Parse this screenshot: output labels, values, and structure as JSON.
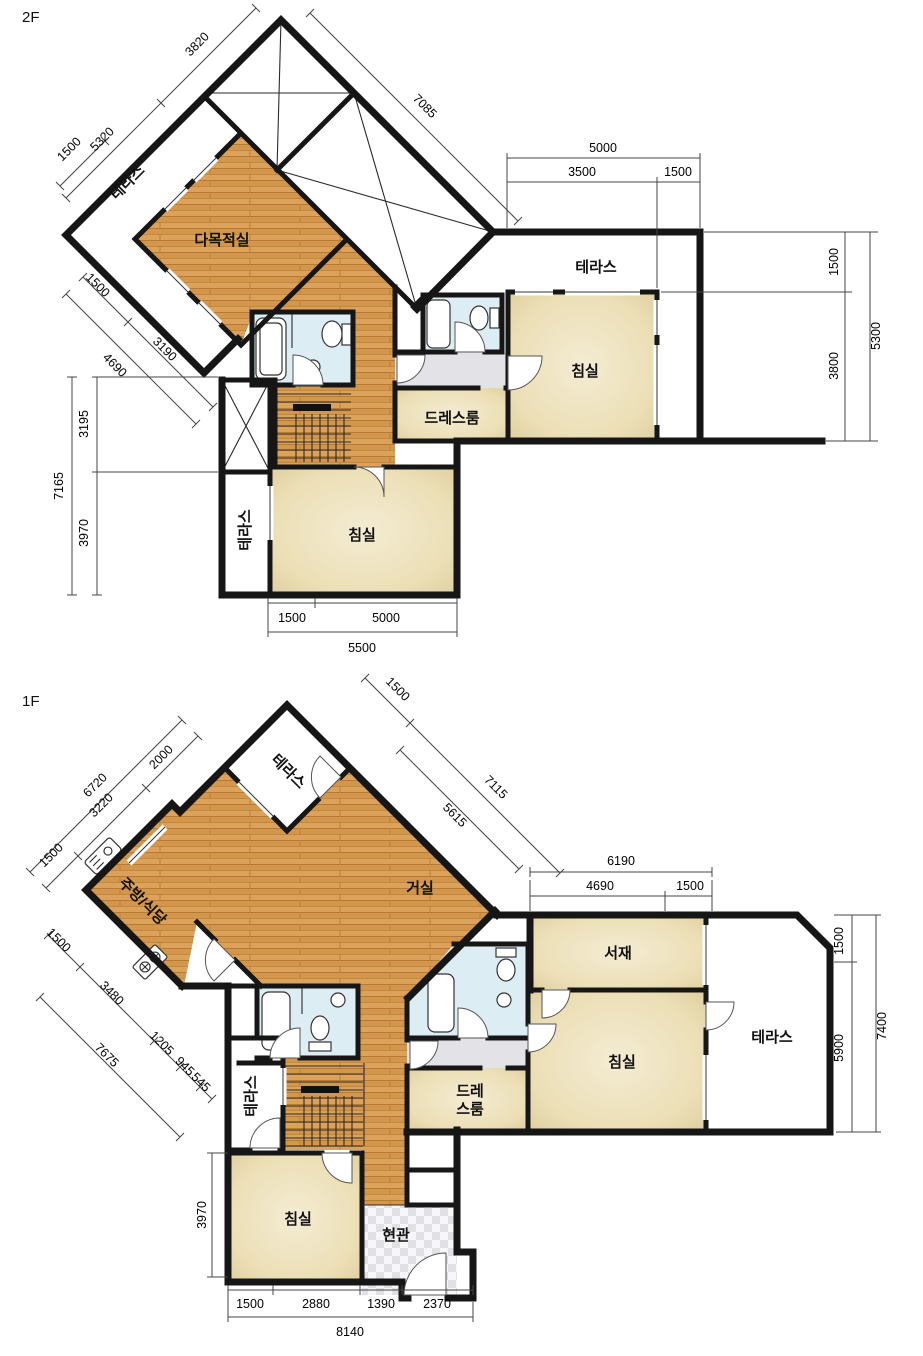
{
  "floors": [
    {
      "label": "2F",
      "rooms": {
        "terrace_nw": "테라스",
        "multi": "다목적실",
        "terrace_e": "테라스",
        "bedroom_e": "침실",
        "dress": "드레스룸",
        "bedroom_s": "침실",
        "terrace_w": "테라스"
      },
      "dims": {
        "d5320": "5320",
        "d3820": "3820",
        "d1500nw": "1500",
        "d7085": "7085",
        "e_total": "5000",
        "e_a": "3500",
        "e_b": "1500",
        "se_a": "1500",
        "se_b": "3800",
        "se_total": "5300",
        "w_a": "3195",
        "w_b": "3970",
        "w_total": "7165",
        "sw_a": "1500",
        "sw_b": "3190",
        "sw_total": "4690",
        "b_a": "1500",
        "b_b": "5000",
        "b_total": "5500"
      }
    },
    {
      "label": "1F",
      "rooms": {
        "terrace_n": "테라스",
        "living": "거실",
        "kitchen": "주방/식당",
        "study": "서재",
        "bedroom_e": "침실",
        "terrace_e": "테라스",
        "dress1": "드레",
        "dress2": "스룸",
        "bedroom_s": "침실",
        "terrace_w": "테라스",
        "entry": "현관"
      },
      "dims": {
        "nw_total": "6720",
        "nw_a": "1500",
        "nw_b": "3220",
        "nw_c": "2000",
        "ne_a": "1500",
        "ne_b": "7115",
        "ne_inner": "5615",
        "e_total": "6190",
        "e_a": "4690",
        "e_b": "1500",
        "se_a": "1500",
        "se_b": "5900",
        "se_total": "7400",
        "sw_a": "1500",
        "sw_b": "3480",
        "sw_c": "1205",
        "sw_d": "945",
        "sw_e": "545",
        "sw_total": "7675",
        "w_a": "3970",
        "b_a": "1500",
        "b_b": "2880",
        "b_c": "1390",
        "b_d": "2370",
        "b_total": "8140"
      }
    }
  ],
  "colors": {
    "wall": "#161616",
    "wood_floor": "#dca25c",
    "room_beige": "#ecdfb6",
    "bath_blue": "#dcedf4",
    "hall_gray": "#e3e3e7"
  }
}
